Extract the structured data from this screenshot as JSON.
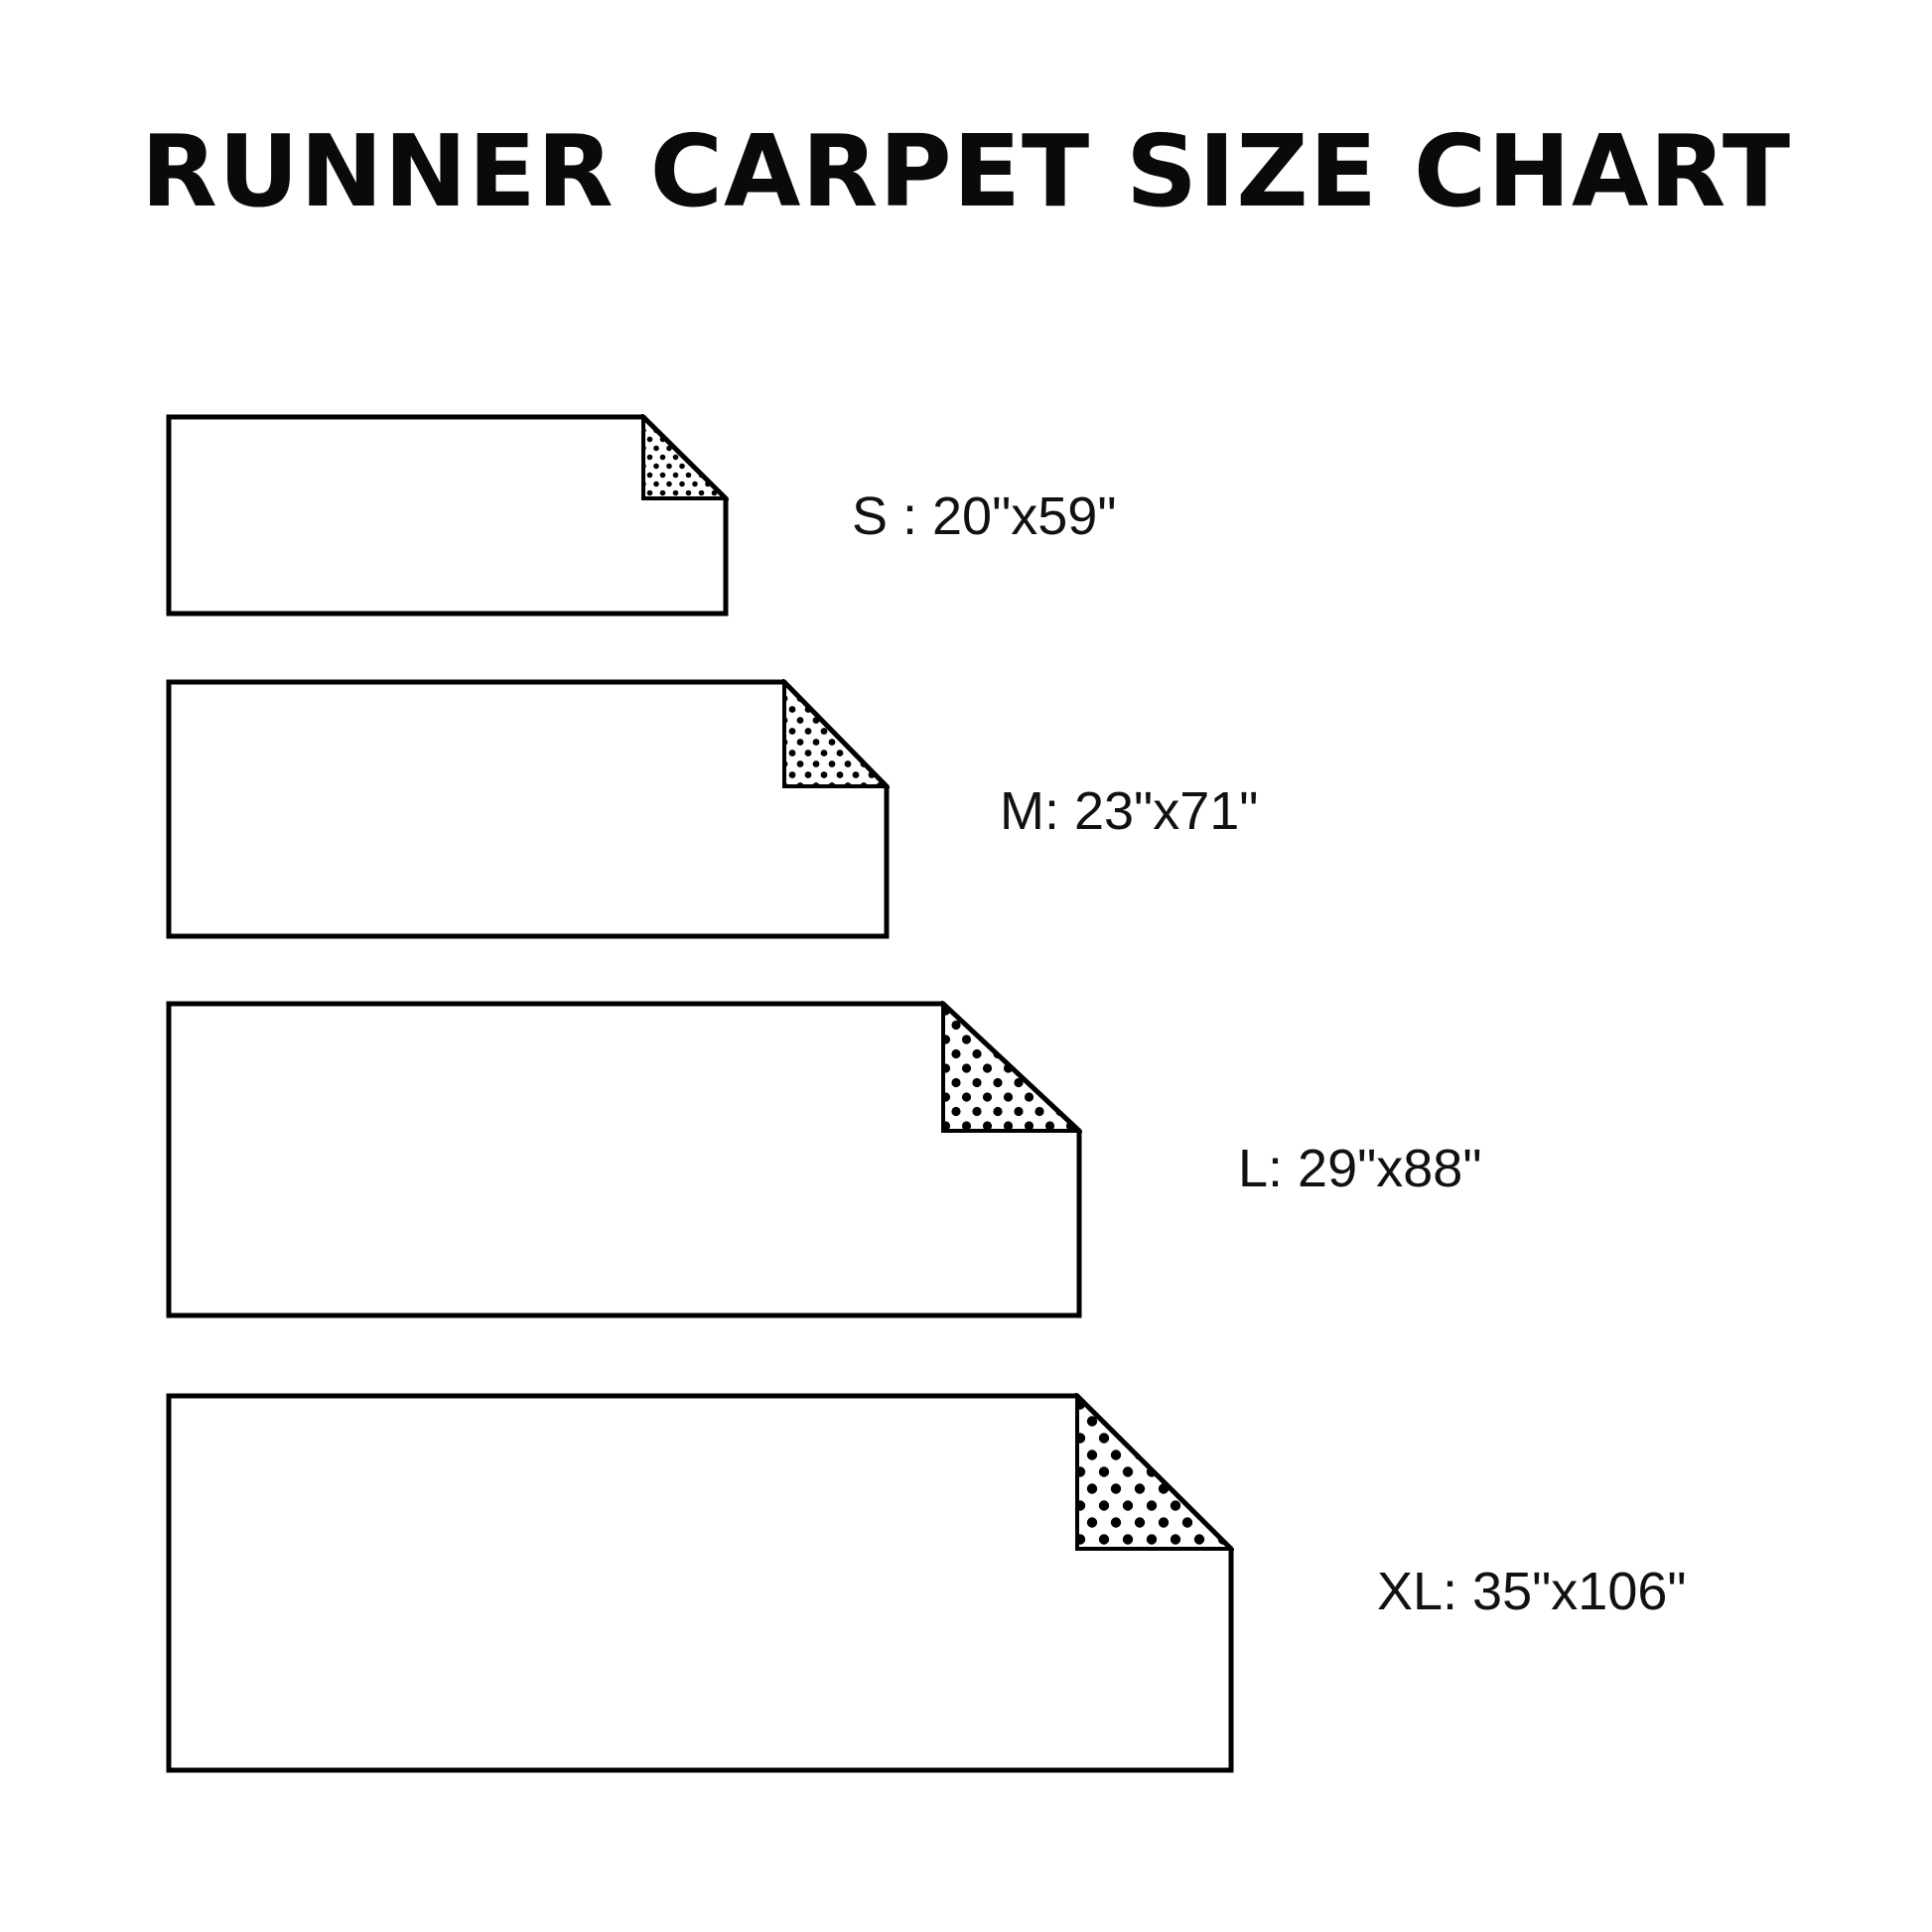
{
  "title": "RUNNER CARPET SIZE CHART",
  "colors": {
    "background": "#ffffff",
    "line": "#000000",
    "text": "#111111"
  },
  "sizes": [
    {
      "code": "S",
      "dimensions": "20\"x59\"",
      "label": "S : 20\"x59\""
    },
    {
      "code": "M",
      "dimensions": "23\"x71\"",
      "label": "M: 23\"x71\""
    },
    {
      "code": "L",
      "dimensions": "29\"x88\"",
      "label": "L: 29\"x88\""
    },
    {
      "code": "XL",
      "dimensions": "35\"x106\"",
      "label": "XL: 35\"x106\""
    }
  ]
}
